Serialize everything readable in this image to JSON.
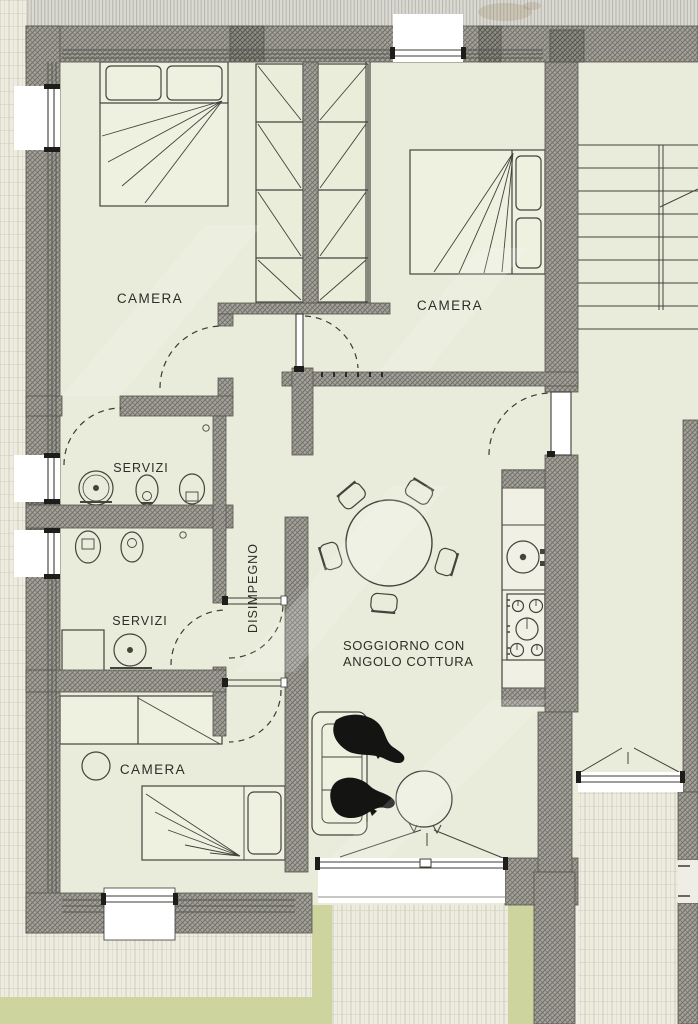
{
  "document": {
    "type": "floor-plan",
    "language": "it",
    "style": "scanned architectural drawing"
  },
  "rooms": {
    "camera1": {
      "label": "CAMERA"
    },
    "camera2": {
      "label": "CAMERA"
    },
    "camera3": {
      "label": "CAMERA"
    },
    "servizi1": {
      "label": "SERVIZI"
    },
    "servizi2": {
      "label": "SERVIZI"
    },
    "disimpegno": {
      "label": "DISIMPEGNO"
    },
    "soggiorno": {
      "line1": "SOGGIORNO CON",
      "line2": "ANGOLO COTTURA"
    }
  },
  "features": [
    "double-bed",
    "double-bed",
    "single-bed",
    "wardrobe",
    "desk",
    "stool",
    "washbasin",
    "bidet",
    "toilet",
    "shower-tray",
    "dining-table",
    "chairs",
    "kitchen-sink",
    "cooktop",
    "sofa",
    "armchair",
    "staircase",
    "entrance-door",
    "balcony",
    "terrace",
    "garden"
  ],
  "colors": {
    "wall": "#a4a39b",
    "wall_dark": "#908f87",
    "floor": "#e9ecda",
    "paper": "#efeee6",
    "grass": "#cdd49e",
    "tile": "#edecdf",
    "line": "#44433d",
    "text": "#2e2d28"
  }
}
